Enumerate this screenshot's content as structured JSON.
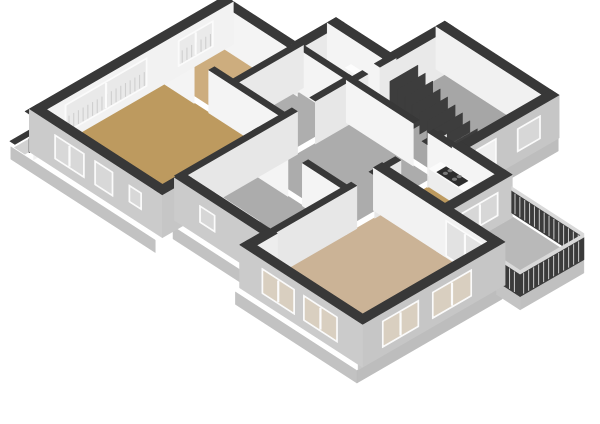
{
  "canvas": {
    "width": 600,
    "height": 424,
    "background": "#FFFFFF"
  },
  "view": {
    "type": "isometric-3d-floorplan",
    "storey": "apartment-floor"
  },
  "palette": {
    "wall_cap": "#383838",
    "int_bright": "#F4F4F4",
    "int_shade": "#E8E8E8",
    "ext_sw": "#CBCBCB",
    "ext_se": "#C5C5C5",
    "window_frame": "#FBFBFB",
    "glass_int": "#E9E9E9",
    "glass_ext": "#D7D7D7",
    "glass_warm": "#D9CFC0",
    "slat_color": "#CFCFCF",
    "railing_dark": "#3B3B3B",
    "railing_top": "#D9D9D9",
    "floor_tan": "#BD9A5F",
    "floor_tan_light": "#CDAD7E",
    "floor_beige": "#CBB396",
    "floor_gray": "#AEAEAE",
    "floor_gray_dark": "#A6A6A6",
    "floor_balcony": "#B9B9B9",
    "slab": "#D2D2D2",
    "skirt_sw": "#C2C2C2",
    "skirt_se": "#BDBDBD",
    "stair_dark": "#3D3D3D",
    "stair_wedge": "#D4D4D4",
    "counter_top": "#FBFBFB",
    "counter_front": "#EDEDED",
    "stove_dark": "#2D2D2D",
    "burner": "#7A7A7A",
    "fixture_white": "#FDFDFD"
  },
  "projection": {
    "ox": 38,
    "oy": 152,
    "kxu": 28.6,
    "kyu": 18.5,
    "kxv": 29.4,
    "kyv": -17,
    "hz": 33
  },
  "walls_meta": {
    "height": 1.3,
    "ext_t": 0.3,
    "int_t": 0.2
  },
  "rooms": [
    {
      "name": "living-room",
      "rect": [
        0.15,
        0.15,
        4.15,
        4.15
      ],
      "color": "#BD9A5F"
    },
    {
      "name": "bedroom-1",
      "rect": [
        0.15,
        4.35,
        2.35,
        6.25
      ],
      "color": "#CDAD7E"
    },
    {
      "name": "closet",
      "rect": [
        2.55,
        4.35,
        4.15,
        6.35
      ],
      "color": "#AEAEAE"
    },
    {
      "name": "wc",
      "rect": [
        2.55,
        6.55,
        4.25,
        7.65
      ],
      "color": "#AEAEAE"
    },
    {
      "name": "stairwell",
      "rect": [
        4.45,
        6.55,
        7.95,
        9.5
      ],
      "color": "#A6A6A6"
    },
    {
      "name": "hallway",
      "rect": [
        4.35,
        3.45,
        7.25,
        6.35
      ],
      "color": "#ACACAC"
    },
    {
      "name": "bathroom",
      "rect": [
        4.35,
        0.8,
        7.25,
        3.25
      ],
      "color": "#ACACAC"
    },
    {
      "name": "kitchen",
      "rect": [
        7.45,
        4.65,
        9.45,
        6.45
      ],
      "color": "#BD9A5F"
    },
    {
      "name": "bedroom-2",
      "rect": [
        7.45,
        0.1,
        11.25,
        4.45
      ],
      "color": "#CBB396"
    },
    {
      "name": "balcony",
      "rect": [
        9.65,
        4.65,
        12.1,
        6.65
      ],
      "color": "#B9B9B9",
      "z": 0.08
    }
  ],
  "deco": [
    {
      "name": "nw-slab-ledge",
      "fill": "#D2D2D2",
      "pts": [
        [
          -0.52,
          -0.3,
          0
        ],
        [
          -0.52,
          6.5,
          0
        ],
        [
          -0.15,
          6.5,
          0
        ],
        [
          -0.15,
          -0.3,
          0
        ]
      ]
    },
    {
      "name": "nw-parapet-cap",
      "fill": "#383838",
      "pts": [
        [
          -0.68,
          -0.3,
          0.1
        ],
        [
          -0.68,
          6.5,
          0.1
        ],
        [
          -0.5,
          6.5,
          0.1
        ],
        [
          -0.5,
          -0.3,
          0.1
        ]
      ]
    },
    {
      "name": "basement-window",
      "fill": "#2F2F2F",
      "pts": [
        [
          -0.52,
          0.2,
          0.02
        ],
        [
          -0.52,
          0.62,
          0.02
        ],
        [
          -0.52,
          0.62,
          -0.42
        ],
        [
          -0.52,
          0.2,
          -0.42
        ]
      ]
    },
    {
      "name": "stair-nw-ledge",
      "fill": "#D0D0D0",
      "pts": [
        [
          4.0,
          7.75,
          0
        ],
        [
          4.0,
          9.72,
          0
        ],
        [
          4.25,
          9.72,
          0
        ],
        [
          4.25,
          7.75,
          0
        ]
      ]
    },
    {
      "name": "wc-nw-ledge",
      "fill": "#D0D0D0",
      "pts": [
        [
          2.4,
          7.75,
          0
        ],
        [
          2.4,
          7.95,
          0
        ],
        [
          4.35,
          7.95,
          0
        ],
        [
          4.35,
          7.75,
          0
        ]
      ]
    },
    {
      "name": "skirt-sw-living",
      "fill": "#C2C2C2",
      "pts": [
        [
          -0.6,
          -0.34,
          0
        ],
        [
          4.45,
          -0.34,
          0
        ],
        [
          4.45,
          -0.34,
          -0.38
        ],
        [
          -0.6,
          -0.34,
          -0.38
        ]
      ]
    },
    {
      "name": "skirt-sw-bath",
      "fill": "#C2C2C2",
      "pts": [
        [
          4.35,
          0.36,
          0
        ],
        [
          7.45,
          0.36,
          0
        ],
        [
          7.45,
          0.36,
          -0.38
        ],
        [
          4.35,
          0.36,
          -0.38
        ]
      ]
    },
    {
      "name": "skirt-sw-bedroom2",
      "fill": "#C2C2C2",
      "pts": [
        [
          7.25,
          -0.34,
          0
        ],
        [
          11.5,
          -0.34,
          0
        ],
        [
          11.5,
          -0.34,
          -0.38
        ],
        [
          7.25,
          -0.34,
          -0.38
        ]
      ]
    },
    {
      "name": "skirt-se-bedroom2",
      "fill": "#BDBDBD",
      "pts": [
        [
          11.5,
          -0.34,
          0
        ],
        [
          11.5,
          4.6,
          0
        ],
        [
          11.5,
          4.6,
          -0.38
        ],
        [
          11.5,
          -0.34,
          -0.38
        ]
      ]
    },
    {
      "name": "skirt-se-stairwell",
      "fill": "#BDBDBD",
      "pts": [
        [
          8.2,
          6.55,
          0
        ],
        [
          8.2,
          9.72,
          0
        ],
        [
          8.2,
          9.72,
          -0.38
        ],
        [
          8.2,
          6.55,
          -0.38
        ]
      ]
    },
    {
      "name": "skirt-kitchen-balcony",
      "fill": "#C0C0C0",
      "pts": [
        [
          9.67,
          4.55,
          0.1
        ],
        [
          9.67,
          6.6,
          0.1
        ],
        [
          9.67,
          6.6,
          -0.3
        ],
        [
          9.67,
          4.55,
          -0.3
        ]
      ]
    },
    {
      "name": "balcony-slab-se",
      "fill": "#C0C0C0",
      "pts": [
        [
          12.18,
          4.55,
          0.1
        ],
        [
          12.18,
          6.72,
          0.1
        ],
        [
          12.18,
          6.72,
          -0.3
        ],
        [
          12.18,
          4.55,
          -0.3
        ]
      ]
    },
    {
      "name": "balcony-slab-sw",
      "fill": "#C4C4C4",
      "pts": [
        [
          11.35,
          4.55,
          0.1
        ],
        [
          12.18,
          4.55,
          0.1
        ],
        [
          12.18,
          4.55,
          -0.3
        ],
        [
          11.35,
          4.55,
          -0.3
        ]
      ]
    }
  ],
  "walls": [
    {
      "name": "nw-facade",
      "axis": "v",
      "c": 0,
      "s1": -0.15,
      "s2": 6.35,
      "t": 0.3,
      "face": "#F2F2F2",
      "windows": [
        {
          "s": 0.75,
          "e": 3.55,
          "z1": 0.26,
          "z2": 1.14,
          "glass": "#E9E9E9",
          "panes": 2,
          "slats": 1
        },
        {
          "s": 4.6,
          "e": 5.8,
          "z1": 0.3,
          "z2": 1.1,
          "glass": "#EAEAEA",
          "panes": 2,
          "slats": 1
        }
      ]
    },
    {
      "name": "bedroom1-end",
      "axis": "u",
      "c": 6.35,
      "s1": 0,
      "s2": 2.55,
      "t": 0.3,
      "face": "#F4F4F4"
    },
    {
      "name": "wc-step",
      "axis": "v",
      "c": 2.45,
      "s1": 6.35,
      "s2": 7.75,
      "t": 0.3,
      "face": "#E9E9E9"
    },
    {
      "name": "wc-nw-facade",
      "axis": "u",
      "c": 7.75,
      "s1": 2.45,
      "s2": 4.35,
      "t": 0.3,
      "face": "#F4F4F4"
    },
    {
      "name": "stair-nw-facade",
      "axis": "v",
      "c": 4.35,
      "s1": 7.75,
      "s2": 9.6,
      "t": 0.3,
      "face": "#E9E9E9"
    },
    {
      "name": "stair-ne-facade",
      "axis": "u",
      "c": 9.6,
      "s1": 4.35,
      "s2": 8.05,
      "t": 0.3,
      "face": "#F1F1F1"
    },
    {
      "name": "stair-se-facade",
      "axis": "v",
      "c": 8.05,
      "s1": 6.55,
      "s2": 9.6,
      "t": 0.3,
      "face": "#C6C6C6",
      "windows": [
        {
          "s": 6.9,
          "e": 7.6,
          "z1": 0.02,
          "z2": 1.12,
          "glass": "#EFEFEF"
        },
        {
          "s": 8.3,
          "e": 9.1,
          "z1": 0.32,
          "z2": 1.04,
          "glass": "#D7D7D7"
        }
      ]
    },
    {
      "name": "kitchen-ne-facade",
      "axis": "u",
      "c": 6.55,
      "s1": 8.05,
      "s2": 9.55,
      "t": 0.3,
      "face": "#F4F4F4"
    },
    {
      "name": "kitchen-se-facade",
      "axis": "v",
      "c": 9.55,
      "s1": 4.55,
      "s2": 6.55,
      "t": 0.3,
      "face": "#C9C9C9",
      "windows": [
        {
          "s": 4.95,
          "e": 6.2,
          "z1": 0.32,
          "z2": 1.05,
          "glass": "#D7D7D7",
          "panes": 2
        }
      ]
    },
    {
      "name": "bedroom2-ne-ext",
      "axis": "u",
      "c": 4.55,
      "s1": 9.55,
      "s2": 11.35,
      "t": 0.3,
      "face": "#F2F2F2",
      "windows": [
        {
          "s": 9.75,
          "e": 11.1,
          "z1": 0.05,
          "z2": 1.16,
          "glass": "#E2E2E2",
          "panes": 2
        }
      ]
    },
    {
      "name": "bedroom2-kitchen-divider",
      "axis": "u",
      "c": 4.55,
      "s1": 7.35,
      "s2": 9.55,
      "t": 0.3,
      "face": "#F2F2F2"
    },
    {
      "name": "bedroom2-se-facade",
      "axis": "v",
      "c": 11.35,
      "s1": -0.15,
      "s2": 4.55,
      "t": 0.3,
      "face": "#C6C6C6",
      "windows": [
        {
          "s": 0.5,
          "e": 1.75,
          "z1": 0.26,
          "z2": 1.08,
          "glass": "#D9CFC0",
          "panes": 2
        },
        {
          "s": 2.2,
          "e": 3.55,
          "z1": 0.26,
          "z2": 1.08,
          "glass": "#D9CFC0",
          "panes": 2
        }
      ]
    },
    {
      "name": "bedroom2-sw-facade",
      "axis": "u",
      "c": 0,
      "s1": 7.35,
      "s2": 11.35,
      "t": 0.3,
      "face": "#CBCBCB",
      "windows": [
        {
          "s": 8.0,
          "e": 9.15,
          "z1": 0.28,
          "z2": 1.06,
          "glass": "#D9CFC0",
          "panes": 2
        },
        {
          "s": 9.45,
          "e": 10.65,
          "z1": 0.28,
          "z2": 1.06,
          "glass": "#D9CFC0",
          "panes": 2
        }
      ]
    },
    {
      "name": "sw-step-b",
      "axis": "v",
      "c": 7.35,
      "s1": 0,
      "s2": 0.7,
      "t": 0.3,
      "face": "#EDEDED"
    },
    {
      "name": "bath-sw-facade",
      "axis": "u",
      "c": 0.7,
      "s1": 4.35,
      "s2": 7.35,
      "t": 0.3,
      "face": "#CBCBCB",
      "windows": [
        {
          "s": 5.1,
          "e": 5.65,
          "z1": 0.45,
          "z2": 0.98,
          "glass": "#D7D7D7"
        }
      ]
    },
    {
      "name": "sw-step-a",
      "axis": "v",
      "c": 4.35,
      "s1": 0,
      "s2": 0.7,
      "t": 0.3,
      "face": "#C6C6C6"
    },
    {
      "name": "living-sw-facade",
      "axis": "u",
      "c": 0,
      "s1": 0,
      "s2": 4.35,
      "t": 0.3,
      "face": "#CBCBCB",
      "windows": [
        {
          "s": 0.75,
          "e": 1.8,
          "z1": 0.3,
          "z2": 1.05,
          "glass": "#D8D8D8",
          "panes": 2
        },
        {
          "s": 2.15,
          "e": 2.8,
          "z1": 0.3,
          "z2": 1.05,
          "glass": "#D8D8D8"
        },
        {
          "s": 3.35,
          "e": 3.8,
          "z1": 0.45,
          "z2": 0.98,
          "glass": "#D8D8D8"
        }
      ]
    },
    {
      "name": "living-ne-a",
      "axis": "v",
      "c": 4.25,
      "s1": 0.7,
      "s2": 4.5,
      "t": 0.2,
      "face": "#E7E7E7"
    },
    {
      "name": "living-ne-b",
      "axis": "v",
      "c": 4.25,
      "s1": 5.3,
      "s2": 6.45,
      "t": 0.2,
      "face": "#E7E7E7"
    },
    {
      "name": "living-bedroom1-a",
      "axis": "u",
      "c": 4.25,
      "s1": 0,
      "s2": 1.1,
      "t": 0.2,
      "face": "#F4F4F4"
    },
    {
      "name": "living-bedroom1-b",
      "axis": "u",
      "c": 4.25,
      "s1": 1.8,
      "s2": 4.25,
      "t": 0.2,
      "face": "#F4F4F4"
    },
    {
      "name": "bedroom1-closet",
      "axis": "v",
      "c": 2.45,
      "s1": 4.25,
      "s2": 6.45,
      "t": 0.2,
      "face": "#E9E9E9"
    },
    {
      "name": "bath-hall-a",
      "axis": "u",
      "c": 3.35,
      "s1": 4.25,
      "s2": 5.3,
      "t": 0.2,
      "face": "#F4F4F4"
    },
    {
      "name": "bath-hall-b",
      "axis": "u",
      "c": 3.35,
      "s1": 6.0,
      "s2": 7.35,
      "t": 0.2,
      "face": "#F4F4F4"
    },
    {
      "name": "bedroom2-hall-a",
      "axis": "v",
      "c": 7.35,
      "s1": 0.7,
      "s2": 3.5,
      "t": 0.2,
      "face": "#E7E7E7"
    },
    {
      "name": "bedroom2-hall-b",
      "axis": "v",
      "c": 7.35,
      "s1": 4.3,
      "s2": 4.55,
      "t": 0.2,
      "face": "#E7E7E7"
    },
    {
      "name": "kitchen-hall-a",
      "axis": "v",
      "c": 7.35,
      "s1": 4.55,
      "s2": 5.0,
      "t": 0.2,
      "face": "#E7E7E7"
    },
    {
      "name": "kitchen-hall-b",
      "axis": "v",
      "c": 7.35,
      "s1": 6.1,
      "s2": 6.55,
      "t": 0.2,
      "face": "#E7E7E7"
    },
    {
      "name": "hall-stair-a",
      "axis": "u",
      "c": 6.45,
      "s1": 2.45,
      "s2": 4.35,
      "t": 0.2,
      "face": "#F4F4F4"
    },
    {
      "name": "hall-stair-b",
      "axis": "u",
      "c": 6.45,
      "s1": 4.35,
      "s2": 6.5,
      "t": 0.2,
      "face": "#F4F4F4"
    },
    {
      "name": "hall-stair-c",
      "axis": "u",
      "c": 6.45,
      "s1": 7.2,
      "s2": 8.05,
      "t": 0.2,
      "face": "#F4F4F4"
    },
    {
      "name": "wc-stair-a",
      "axis": "v",
      "c": 4.35,
      "s1": 6.45,
      "s2": 6.8,
      "t": 0.2,
      "face": "#E9E9E9"
    },
    {
      "name": "wc-stair-b",
      "axis": "v",
      "c": 4.35,
      "s1": 7.4,
      "s2": 7.75,
      "t": 0.2,
      "face": "#E9E9E9"
    }
  ],
  "features": {
    "stairs": {
      "u0": 4.75,
      "du": 0.26,
      "n": 10,
      "v1": 7.35,
      "v2": 8.3,
      "h0": 1.02,
      "dh": 0.095
    },
    "toilet": {
      "u": 3.33,
      "v": 7.12,
      "tank": [
        3.15,
        7.38,
        3.55,
        7.58
      ],
      "tank_h": 0.52
    },
    "bathtub": {
      "u1": 4.55,
      "u2": 6.1,
      "v1": 0.95,
      "v2": 1.6,
      "h": 0.5
    },
    "counter": {
      "u1": 7.45,
      "u2": 9.4,
      "v1": 6.05,
      "v2": 6.45,
      "h": 0.55,
      "stove": {
        "u1": 7.68,
        "u2": 8.45
      },
      "sink": {
        "u1": 8.75,
        "u2": 9.18
      }
    },
    "railings": [
      {
        "axis": "u",
        "c": 6.72,
        "s1": 9.65,
        "s2": 12.18
      },
      {
        "axis": "v",
        "c": 12.18,
        "s1": 4.55,
        "s2": 6.72
      },
      {
        "axis": "u",
        "c": 4.55,
        "s1": 11.35,
        "s2": 12.18
      }
    ]
  }
}
